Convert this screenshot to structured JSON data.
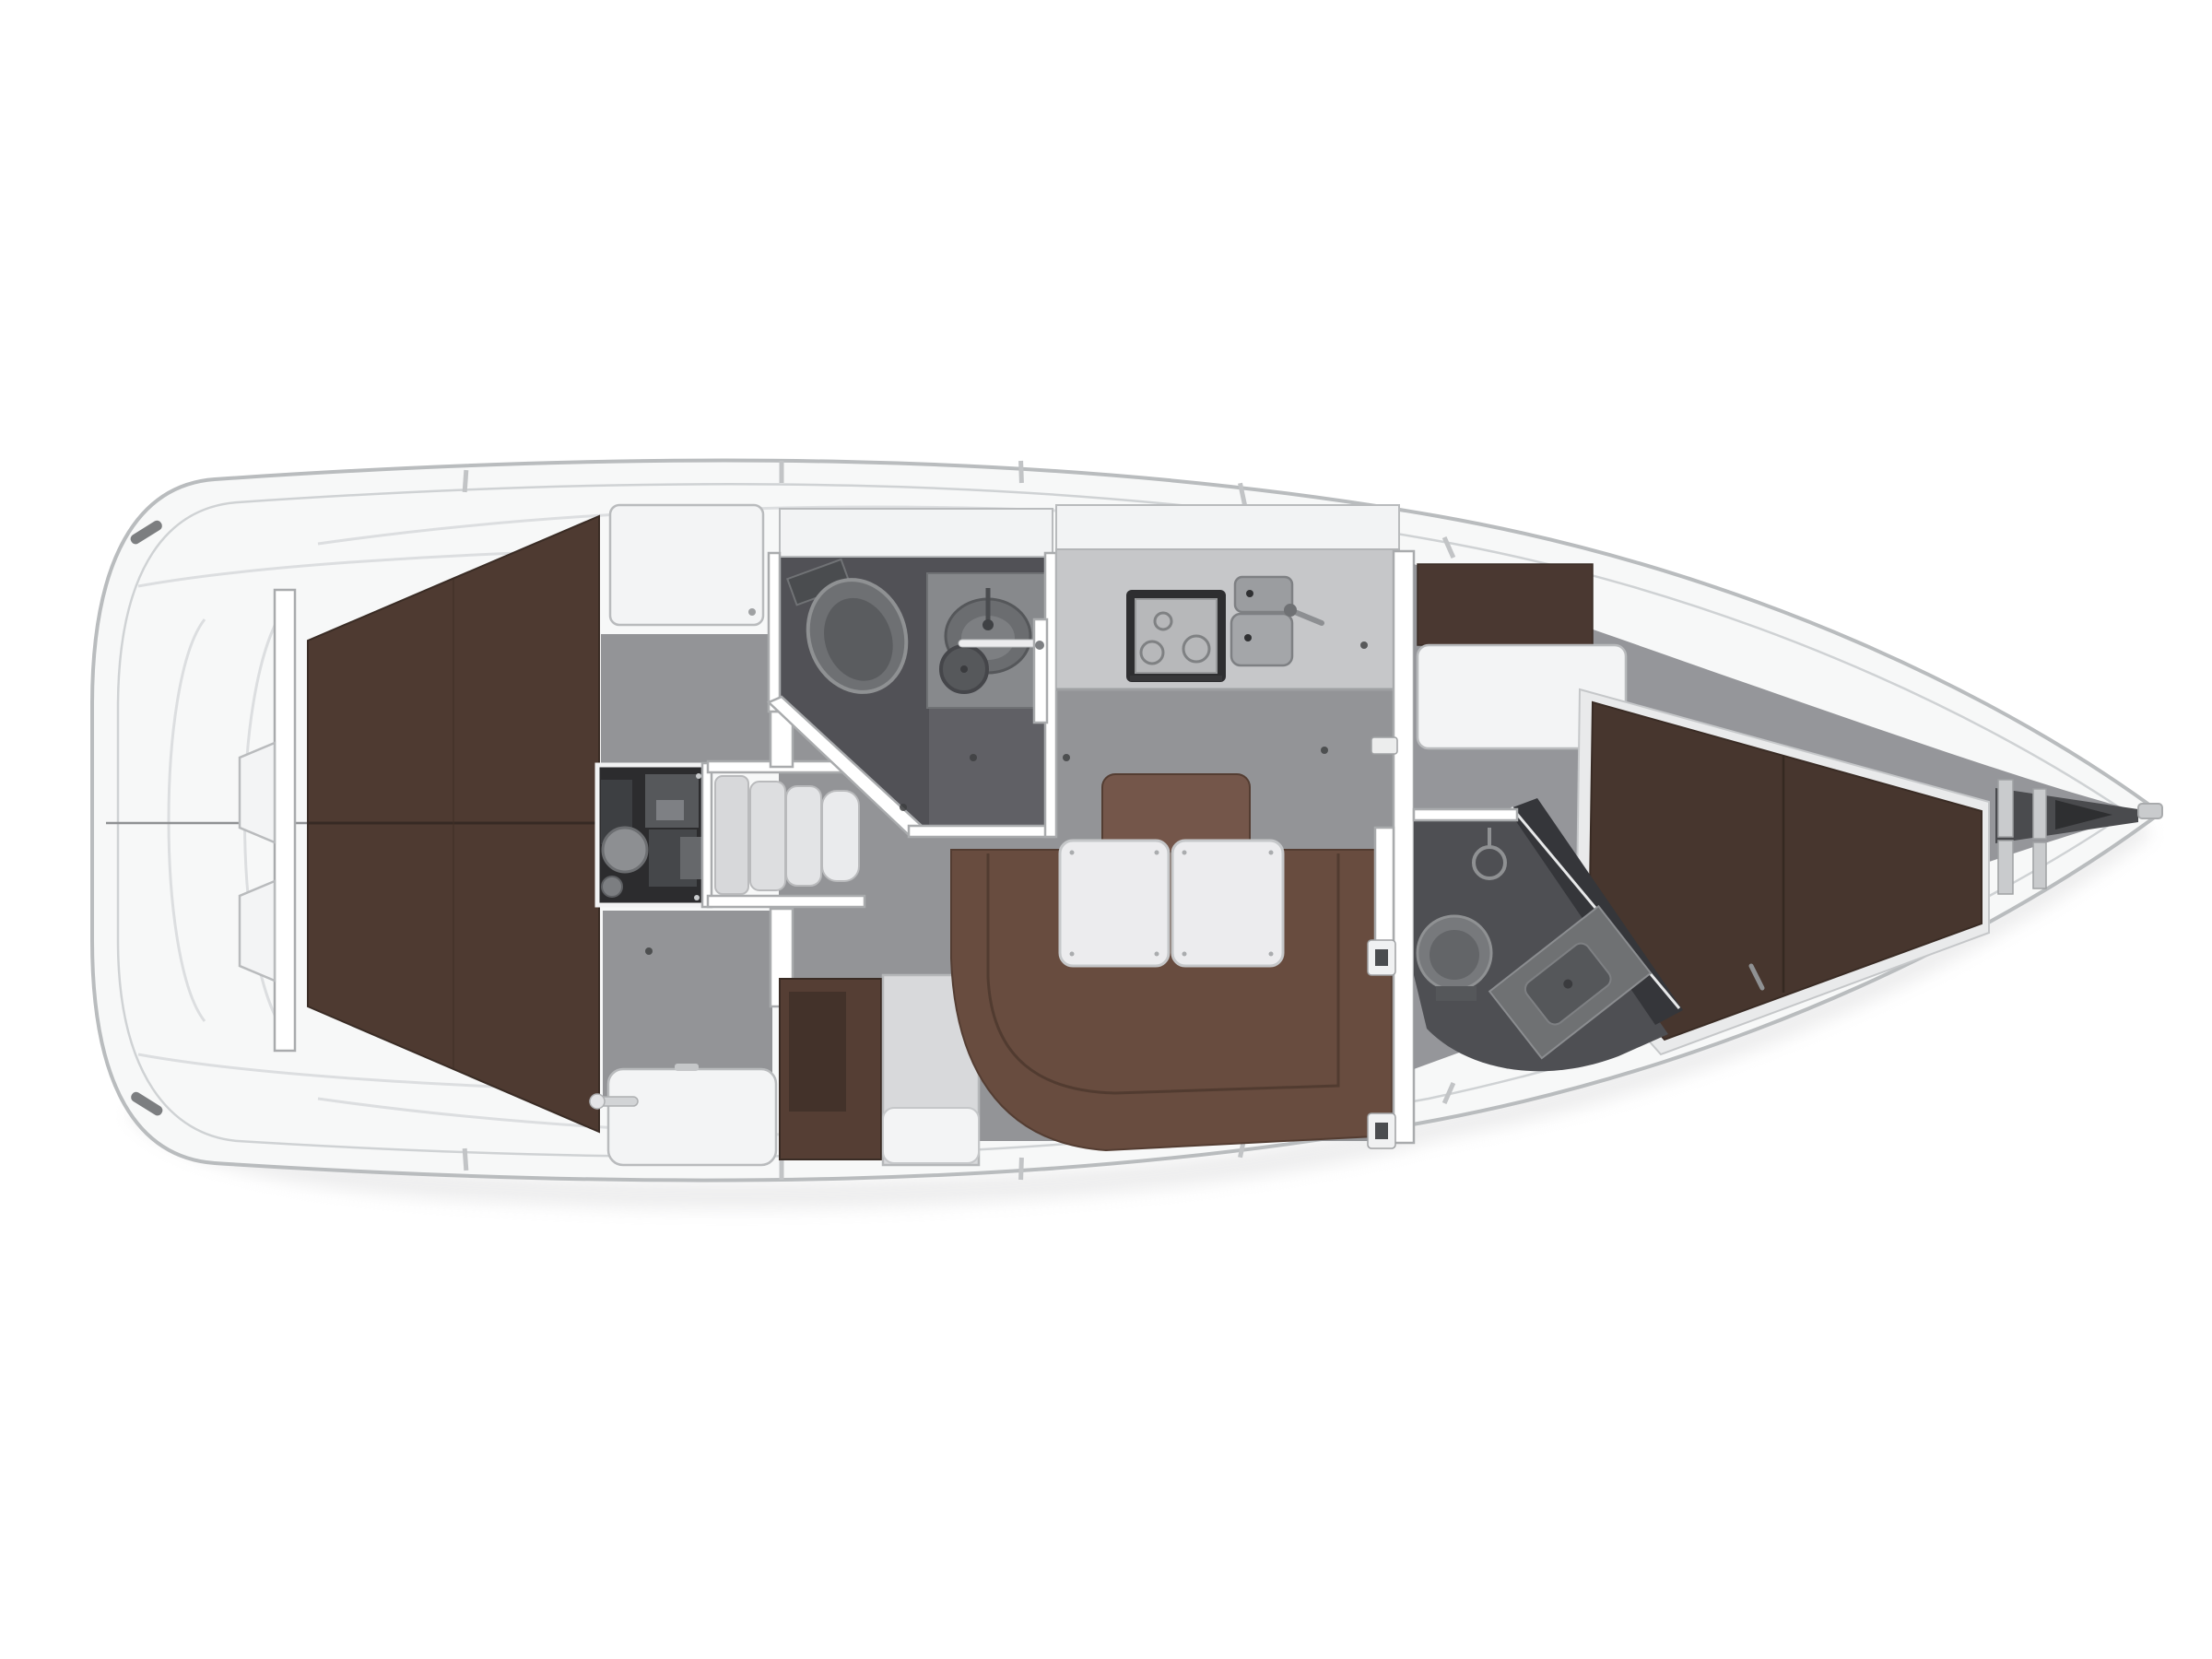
{
  "view": {
    "type": "boat-interior-floor-plan",
    "orientation": "bow-right",
    "background": "#ffffff"
  },
  "palette": {
    "hull_fill": "#f7f8f8",
    "hull_stroke": "#b9bcbe",
    "inner_line": "#cfd2d4",
    "deck_detail": "#dcdee0",
    "floor": "#939497",
    "shell_gray": "#95969a",
    "berth_brown": "#4e3a31",
    "berth_edge": "#3a2c25",
    "vberth_brown": "#47362e",
    "settee_brown": "#684c3f",
    "settee_edge": "#543d32",
    "settee_inner": "#4e382e",
    "backrest_brown": "#74564a",
    "fridge_brown": "#553e34",
    "shelf_brown": "#4a3831",
    "table_white": "#ececee",
    "cabinet_white": "#f3f4f5",
    "cabinet_stroke": "#b9bbbd",
    "wall_fill": "#ffffff",
    "wall_stroke": "#a9abad",
    "head_floor": "#515156",
    "head_floor_light": "#606065",
    "fwd_head_floor": "#4e4f53",
    "shower_wall": "#35363a",
    "engine_dark": "#2c2c2e",
    "counter": "#c6c7c9",
    "counter_edge": "#b2b4b6",
    "counter_top": "#f2f3f4",
    "stove_dark": "#2e2e30",
    "stove_top": "#b7b8ba",
    "fixture_gray": "#87898c",
    "fixture_dark": "#55575a",
    "metal": "#9b9da0",
    "shadow": "#d9d9da"
  },
  "features": [
    "hull",
    "swim-platform",
    "stern-cleats",
    "aft-bulkhead",
    "rudder-linkage",
    "aft-double-berth",
    "berth-centerline-seam",
    "engine-compartment",
    "companionway-stairs",
    "aft-head",
    "toilet",
    "washbasin",
    "shower-drain",
    "galley",
    "stove",
    "double-sink",
    "faucet",
    "salon-floor",
    "salon-settee",
    "settee-backrest",
    "folding-table-left",
    "folding-table-right",
    "fridge-cabinet",
    "nav-cabinet",
    "stowage-locker",
    "main-bulkhead",
    "head-door",
    "door-hinges",
    "forward-head",
    "shower-partition",
    "vanity-sink",
    "shower-head",
    "forward-cabin",
    "v-berth",
    "wardrobe-cabinet",
    "shelf-band",
    "bow-lockers",
    "anchor-locker",
    "bow-fitting",
    "deck-stanchions",
    "genoa-track"
  ]
}
